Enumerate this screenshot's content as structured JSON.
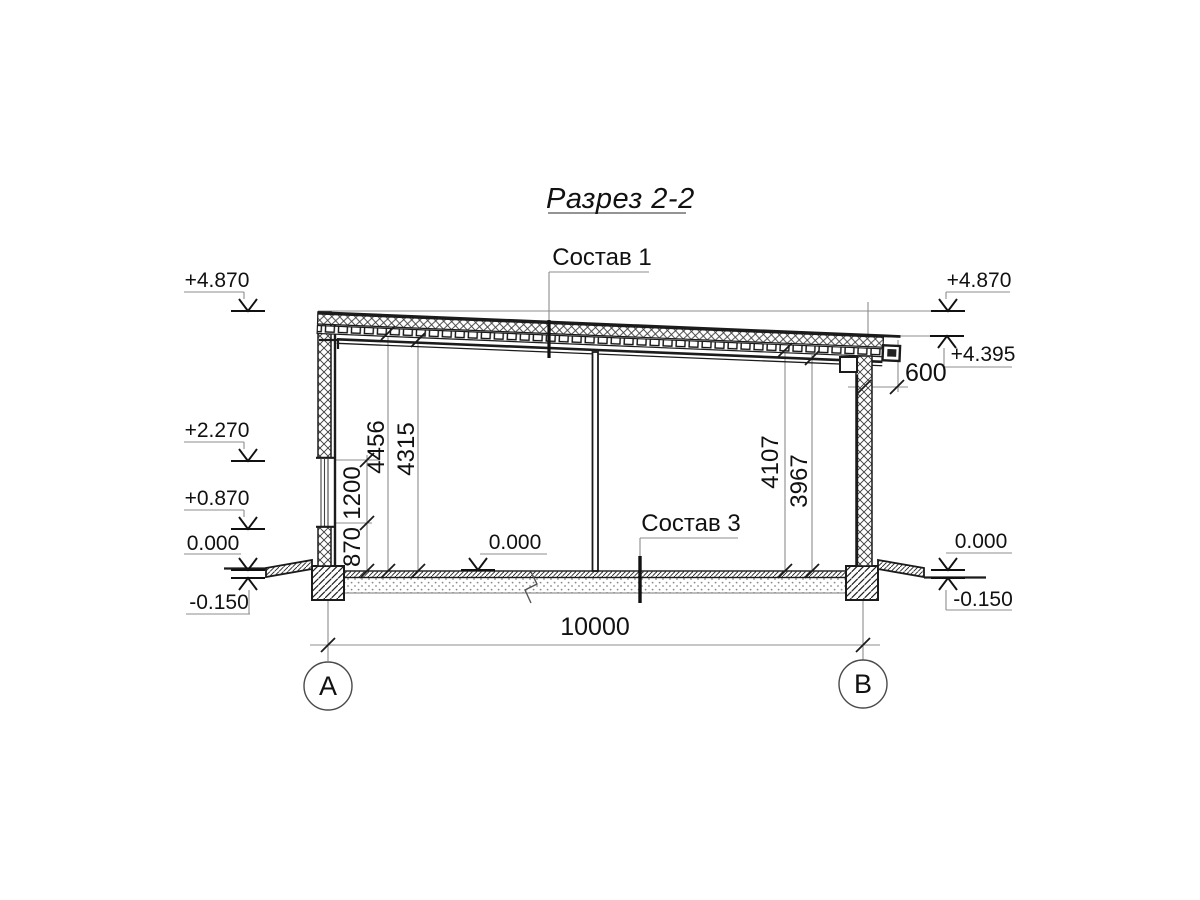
{
  "drawing": {
    "title": "Разрез 2-2",
    "roof_layers_label": "Состав 1",
    "floor_layers_label": "Состав 3",
    "axis_left": "А",
    "axis_right": "В"
  },
  "levels": {
    "left_top": "+4.870",
    "left_mid": "+2.270",
    "left_low": "+0.870",
    "left_zero": "0.000",
    "left_ground": "-0.150",
    "right_top": "+4.870",
    "right_eave": "+4.395",
    "right_zero": "0.000",
    "right_ground": "-0.150",
    "floor_zero": "0.000"
  },
  "dims": {
    "total_width": "10000",
    "overhang": "600",
    "h_left_1": "4456",
    "h_left_2": "4315",
    "window_h": "1200",
    "sill_h": "870",
    "h_right_1": "4107",
    "h_right_2": "3967"
  },
  "colors": {
    "line": "#1b1b1b",
    "thin": "#8c8c8c",
    "background": "#ffffff"
  }
}
